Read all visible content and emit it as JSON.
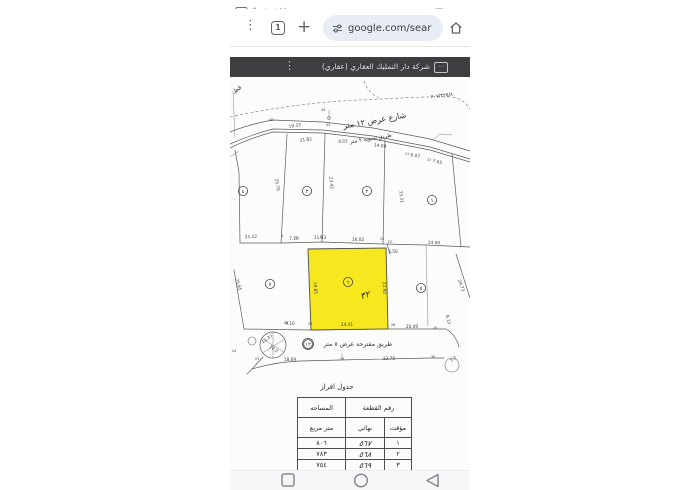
{
  "status": {
    "time": "11:50"
  },
  "toolbar": {
    "tab_count": "1",
    "url": "google.com/sear"
  },
  "viewer": {
    "title": "شركة دار التمليك العقاري (عقاري)"
  },
  "map": {
    "ref_number": "٢٠٧/٣٢٥/٨",
    "corner_word": "قطـ",
    "street_12m": "شارع عرض ١٢ متر",
    "road_2m": "طريق تسوية ٢ متر",
    "road_8m": "طريق مقترحة عرض ٨ متر",
    "road_8m_number": "١٢",
    "handwritten_mark": "٣٢",
    "highlight_color": "#f7e71f",
    "plots": [
      {
        "label": "٤",
        "x": 13,
        "y": 114
      },
      {
        "label": "٣",
        "x": 77,
        "y": 114
      },
      {
        "label": "٢",
        "x": 137,
        "y": 114
      },
      {
        "label": "١",
        "x": 202,
        "y": 123
      },
      {
        "label": "٧",
        "x": 40,
        "y": 207
      },
      {
        "label": "٦",
        "x": 118,
        "y": 205,
        "highlight": true
      },
      {
        "label": "٥",
        "x": 191,
        "y": 211
      },
      {
        "label": "١٢",
        "x": 78,
        "y": 267,
        "double": true
      }
    ],
    "dims": [
      {
        "t": "19.33",
        "x": 65,
        "y": 50,
        "r": -8
      },
      {
        "t": "21.82",
        "x": 76,
        "y": 64,
        "r": -6
      },
      {
        "t": "4.07",
        "x": 113,
        "y": 66,
        "r": 0
      },
      {
        "t": "14.09",
        "x": 150,
        "y": 70,
        "r": 8
      },
      {
        "t": "6.07",
        "x": 185,
        "y": 80,
        "r": 12
      },
      {
        "t": "7.65",
        "x": 207,
        "y": 86,
        "r": 15
      },
      {
        "t": "25.76",
        "x": 46,
        "y": 108,
        "r": 82
      },
      {
        "t": "23.42",
        "x": 100,
        "y": 106,
        "r": 84
      },
      {
        "t": "33.31",
        "x": 170,
        "y": 120,
        "r": 84
      },
      {
        "t": "21.22",
        "x": 21,
        "y": 161,
        "r": -2
      },
      {
        "t": "7.19",
        "x": 64,
        "y": 163,
        "r": 0
      },
      {
        "t": "11.33",
        "x": 90,
        "y": 162,
        "r": 0
      },
      {
        "t": "16.02",
        "x": 128,
        "y": 164,
        "r": 0
      },
      {
        "t": "24.00",
        "x": 204,
        "y": 167,
        "r": 2
      },
      {
        "t": "5.50",
        "x": 163,
        "y": 176,
        "r": 0
      },
      {
        "t": "25.65",
        "x": 7,
        "y": 208,
        "r": 72
      },
      {
        "t": "19.85",
        "x": 84,
        "y": 211,
        "r": 86
      },
      {
        "t": "22.92",
        "x": 153,
        "y": 211,
        "r": 87
      },
      {
        "t": "24.73",
        "x": 230,
        "y": 209,
        "r": 70
      },
      {
        "t": "9.10",
        "x": 60,
        "y": 248,
        "r": 0
      },
      {
        "t": "24.41",
        "x": 117,
        "y": 249,
        "r": 0
      },
      {
        "t": "20.49",
        "x": 182,
        "y": 251,
        "r": 0
      },
      {
        "t": "18.69",
        "x": 60,
        "y": 284,
        "r": 0
      },
      {
        "t": "32.70",
        "x": 159,
        "y": 283,
        "r": 0
      },
      {
        "t": "11.37",
        "x": 38,
        "y": 263,
        "r": -35
      },
      {
        "t": "10.2",
        "x": 43,
        "y": 273,
        "r": 35
      },
      {
        "t": "8.12",
        "x": 217,
        "y": 243,
        "r": 75
      },
      {
        "t": "5.2",
        "x": 224,
        "y": 283,
        "r": -35
      }
    ],
    "points": [
      {
        "t": "45",
        "x": 41,
        "y": 44
      },
      {
        "t": "44",
        "x": 93,
        "y": 34
      },
      {
        "t": "43",
        "x": 98,
        "y": 49
      },
      {
        "t": "11",
        "x": 177,
        "y": 78
      },
      {
        "t": "37",
        "x": 199,
        "y": 84
      },
      {
        "t": "4",
        "x": 52,
        "y": 160
      },
      {
        "t": "5",
        "x": 66,
        "y": 162
      },
      {
        "t": "8",
        "x": 91,
        "y": 161
      },
      {
        "t": "23",
        "x": 152,
        "y": 163
      },
      {
        "t": "22",
        "x": 160,
        "y": 166
      },
      {
        "t": "29",
        "x": 56,
        "y": 247
      },
      {
        "t": "28",
        "x": 80,
        "y": 248
      },
      {
        "t": "26",
        "x": 163,
        "y": 249
      },
      {
        "t": "18",
        "x": 205,
        "y": 252
      },
      {
        "t": "24",
        "x": 4,
        "y": 275
      },
      {
        "t": "23",
        "x": 27,
        "y": 283
      },
      {
        "t": "19",
        "x": 112,
        "y": 283
      },
      {
        "t": "30",
        "x": 203,
        "y": 281
      }
    ]
  },
  "table": {
    "title": "جدول افراز",
    "col_plot_number": "رقم القطعة",
    "col_area": "المساحه",
    "sub_temporary": "مؤقت",
    "sub_final": "نهائي",
    "sub_unit": "متر مربع",
    "rows": [
      {
        "temporary": "١",
        "final": "٥٦٧",
        "area": "٨٠٦"
      },
      {
        "temporary": "٢",
        "final": "٥٦٨",
        "area": "٧٨٣"
      },
      {
        "temporary": "٣",
        "final": "٥٦٩",
        "area": "٧٥٤"
      }
    ]
  }
}
